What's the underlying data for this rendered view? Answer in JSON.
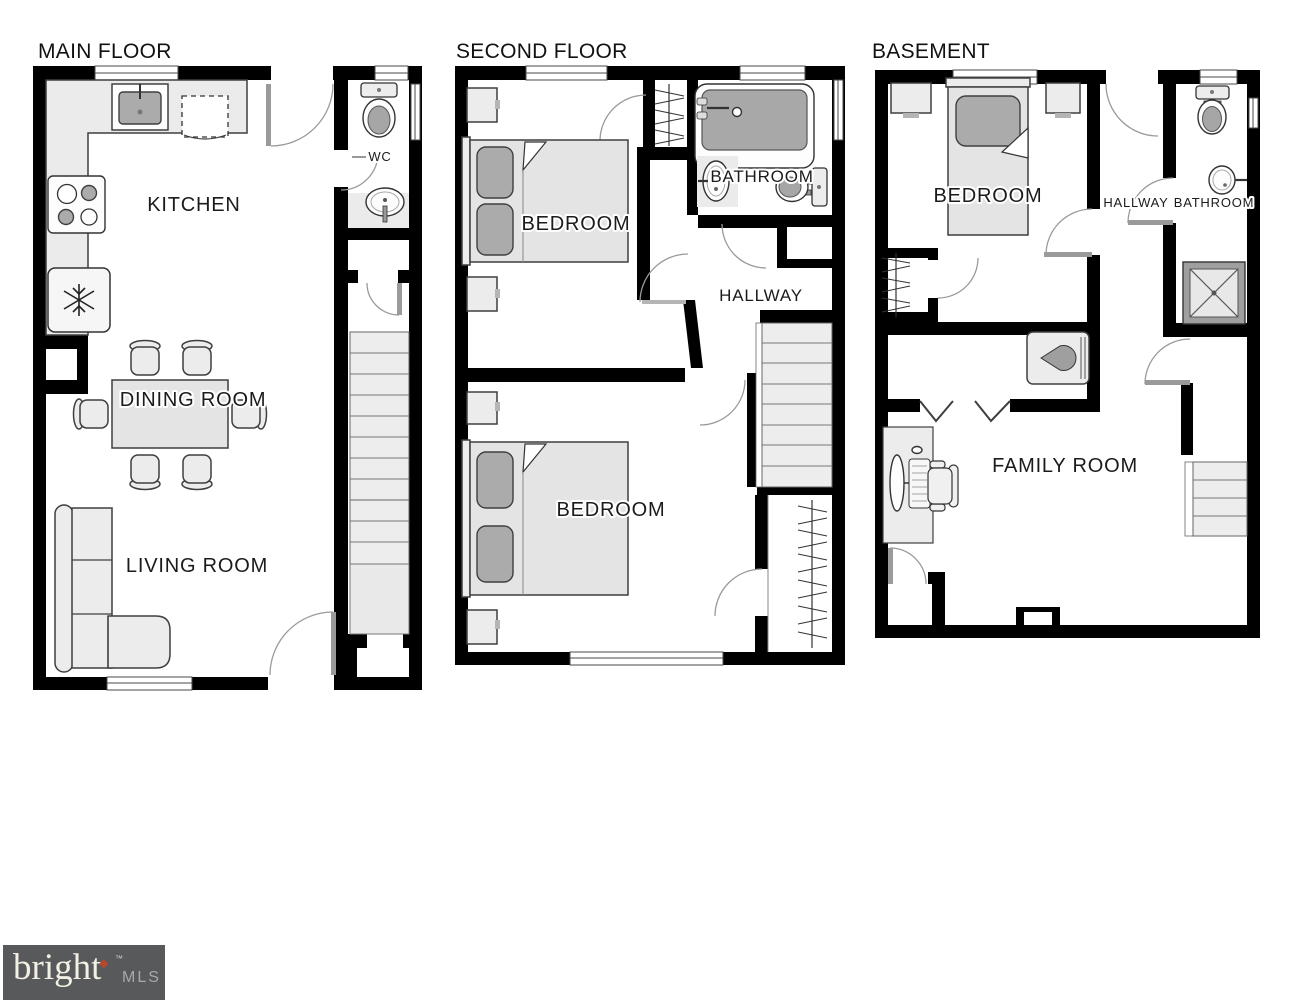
{
  "colors": {
    "wall": "#000000",
    "furniture_fill": "#ececec",
    "furniture_dark": "#ababab",
    "label_text": "#1b1b1b",
    "door_arc": "#9a9a9a",
    "logo_background": "#58595b",
    "logo_brand_text": "#f2efe4",
    "logo_mls_text": "#a7a9ac",
    "logo_diamond": "#b5492f"
  },
  "floors": [
    {
      "label": "MAIN FLOOR",
      "rooms": {
        "kitchen": "KITCHEN",
        "wc": "WC",
        "dining": "DINING ROOM",
        "living": "LIVING ROOM"
      }
    },
    {
      "label": "SECOND FLOOR",
      "rooms": {
        "bedroom1": "BEDROOM",
        "bathroom": "BATHROOM",
        "hallway": "HALLWAY",
        "bedroom2": "BEDROOM"
      }
    },
    {
      "label": "BASEMENT",
      "rooms": {
        "bedroom": "BEDROOM",
        "hallway": "HALLWAY",
        "bathroom": "BATHROOM",
        "family": "FAMILY ROOM"
      }
    }
  ],
  "logo": {
    "brand": "bright",
    "diamond": "◆",
    "tm": "™",
    "name": "MLS"
  }
}
